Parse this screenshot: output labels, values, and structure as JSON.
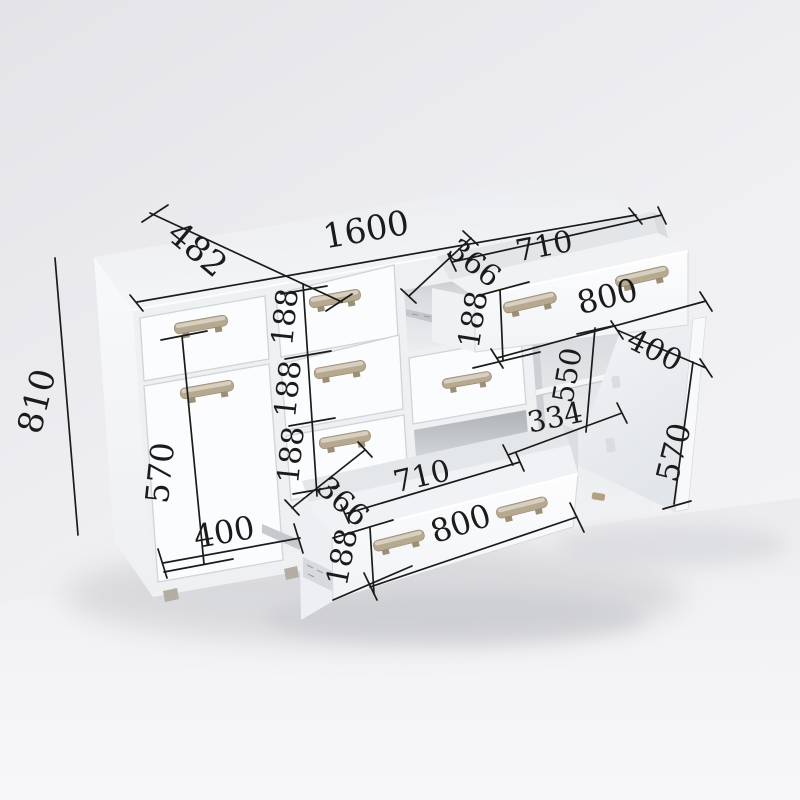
{
  "dimensions": {
    "overall": {
      "width": "1600",
      "depth": "482",
      "height": "810"
    },
    "left_section": {
      "door_height": "570",
      "door_width": "400"
    },
    "center_drawers": {
      "heights": [
        "188",
        "188",
        "188"
      ]
    },
    "top_drawer": {
      "side_depth": "366",
      "inner_width": "710",
      "front_width": "800",
      "front_height": "188"
    },
    "bottom_drawer": {
      "side_depth": "366",
      "inner_width": "710",
      "front_width": "800",
      "front_height": "188"
    },
    "right_door": {
      "width": "400",
      "height": "570"
    },
    "right_compartment": {
      "inner_height": "550",
      "inner_width": "334"
    }
  },
  "colors": {
    "handle": "#b7a890",
    "dimension_line": "#1b1b1b",
    "cabinet_white": "#fbfcfd",
    "wall": "#ededf0"
  }
}
